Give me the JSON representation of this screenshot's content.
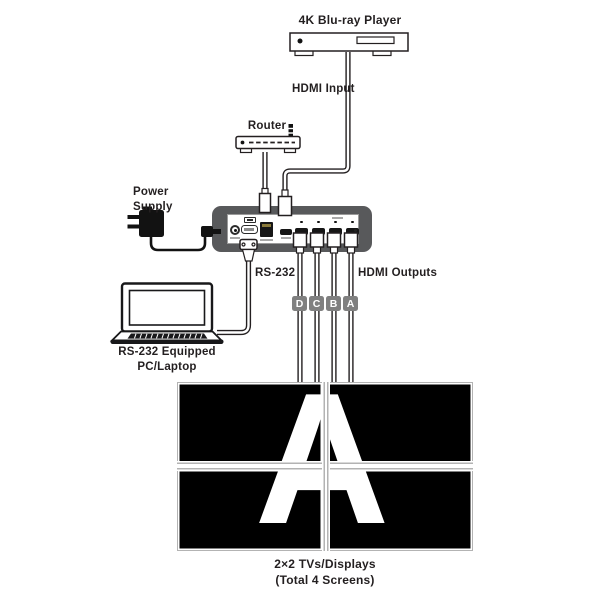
{
  "theme": {
    "ink": "#231f20",
    "device-body": "#58595b",
    "panel-border": "#9a9a9a",
    "tag-bg": "#808080",
    "bezel": "#b3b3b3",
    "screen": "#000000",
    "letter": "#ffffff"
  },
  "diagram": {
    "bluray": {
      "label": "4K Blu-ray Player"
    },
    "hdmi_input": {
      "label": "HDMI Input"
    },
    "router": {
      "label": "Router"
    },
    "power_supply": {
      "label": "Power\nSupply"
    },
    "rs232": {
      "label": "RS-232"
    },
    "hdmi_outputs": {
      "label": "HDMI Outputs"
    },
    "output_tags": [
      "D",
      "C",
      "B",
      "A"
    ],
    "laptop": {
      "label": "RS-232 Equipped\nPC/Laptop"
    },
    "wall": {
      "letter": "A",
      "caption": "2×2 TVs/Displays\n(Total 4 Screens)"
    }
  }
}
